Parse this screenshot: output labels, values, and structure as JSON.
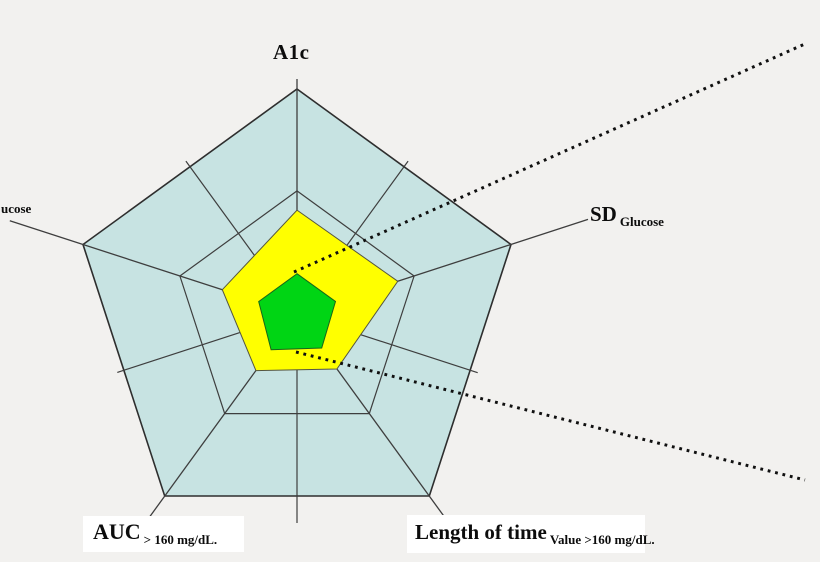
{
  "figure": {
    "background_color": "#f2f1ef",
    "labels": {
      "a1c": "A1c",
      "sd_main": "SD",
      "sd_sub": "Glucose",
      "left_clipped": "ucose",
      "auc_main": "AUC",
      "auc_sub": "> 160 mg/dL.",
      "length_main": "Length of time",
      "length_sub": "Value >160 mg/dL."
    }
  },
  "chart_data": {
    "type": "radar",
    "title": "",
    "grid": "pentagon outline, one inner pentagonal ring, spokes to all 5 vertices and through all 5 edge midpoints",
    "legend": "none",
    "axes": [
      {
        "label": "A1c",
        "angle_deg": 90
      },
      {
        "label": "SD Glucose",
        "angle_deg": 18
      },
      {
        "label": "Length of time Value >160 mg/dL.",
        "angle_deg": 306
      },
      {
        "label": "AUC > 160 mg/dL.",
        "angle_deg": 234
      },
      {
        "label": "ucose (label clipped at image edge)",
        "angle_deg": 162
      }
    ],
    "ring_fractions": [
      0.547,
      1.0
    ],
    "series": [
      {
        "name": "outer-zone",
        "fill": "#c7e3e2",
        "stroke": "#2e2e2e",
        "values": [
          1,
          1,
          1,
          1,
          1
        ]
      },
      {
        "name": "middle-zone",
        "fill": "#ffff00",
        "stroke": "#55553f",
        "values": [
          0.462,
          0.471,
          0.302,
          0.311,
          0.349
        ]
      },
      {
        "name": "inner-zone",
        "fill": "#00d514",
        "stroke": "#17651a",
        "values": [
          0.179,
          0.18,
          0.187,
          0.196,
          0.179
        ]
      }
    ],
    "grid_color": "#3e3e3e",
    "callout_color": "#101010",
    "annotations": [
      {
        "name": "upper-dotted-callout",
        "from_xy": [
          294,
          272
        ],
        "to_xy": [
          807,
          43
        ],
        "style": "dotted"
      },
      {
        "name": "lower-dotted-callout",
        "from_xy": [
          296,
          352
        ],
        "to_xy": [
          805,
          480
        ],
        "style": "dotted"
      }
    ]
  }
}
